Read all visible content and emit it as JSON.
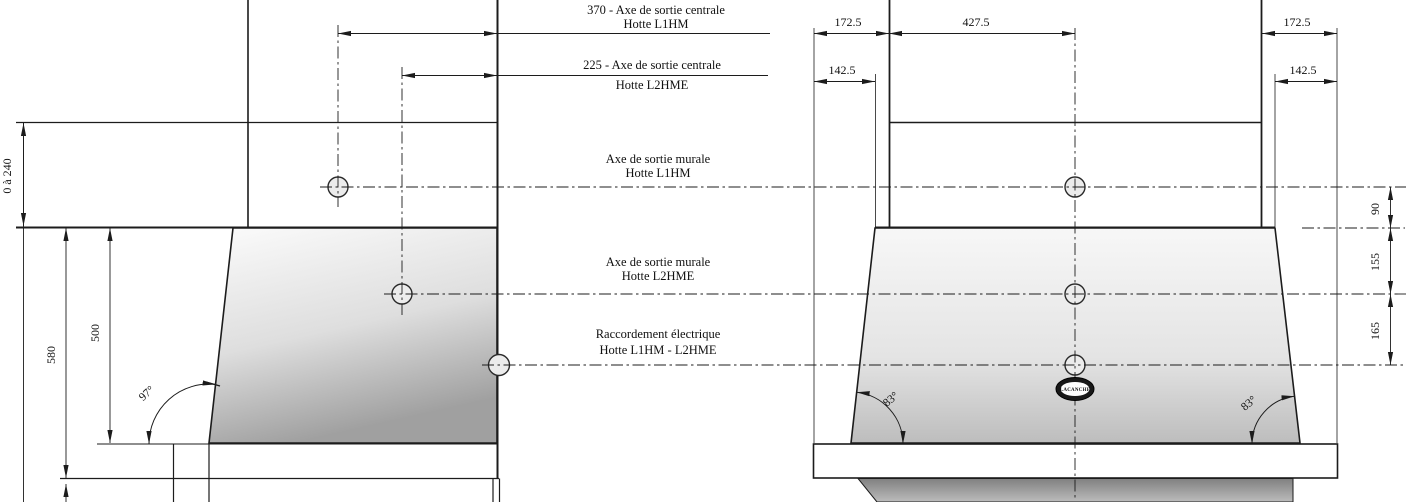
{
  "drawing": {
    "title_semantics": "Cooker hood installation dimensions, side view and front view",
    "colors": {
      "line": "#1c1c1c",
      "glass_light": "#fbfbfb",
      "glass_dark": "#a0a0a0",
      "under_gray": "#8a8a8a"
    },
    "callouts": {
      "c370_line1": "370 - Axe de sortie centrale",
      "c370_line2": "Hotte L1HM",
      "c225_line1": "225 - Axe de sortie centrale",
      "c225_line2": "Hotte L2HME",
      "murale1_line1": "Axe de sortie murale",
      "murale1_line2": "Hotte L1HM",
      "murale2_line1": "Axe de sortie murale",
      "murale2_line2": "Hotte L2HME",
      "racc_line1": "Raccordement électrique",
      "racc_line2": "Hotte L1HM - L2HME"
    },
    "left_view": {
      "dim_adjustable": "0 à 240",
      "dim_500": "500",
      "dim_580": "580",
      "angle": "97°"
    },
    "right_view": {
      "dim_top_left": "172.5",
      "dim_top_center": "427.5",
      "dim_top_right": "172.5",
      "dim_mid_left": "142.5",
      "dim_mid_right": "142.5",
      "dim_90": "90",
      "dim_155": "155",
      "dim_165": "165",
      "angle_left": "83°",
      "angle_right": "83°",
      "badge": "LACANCHE"
    }
  }
}
